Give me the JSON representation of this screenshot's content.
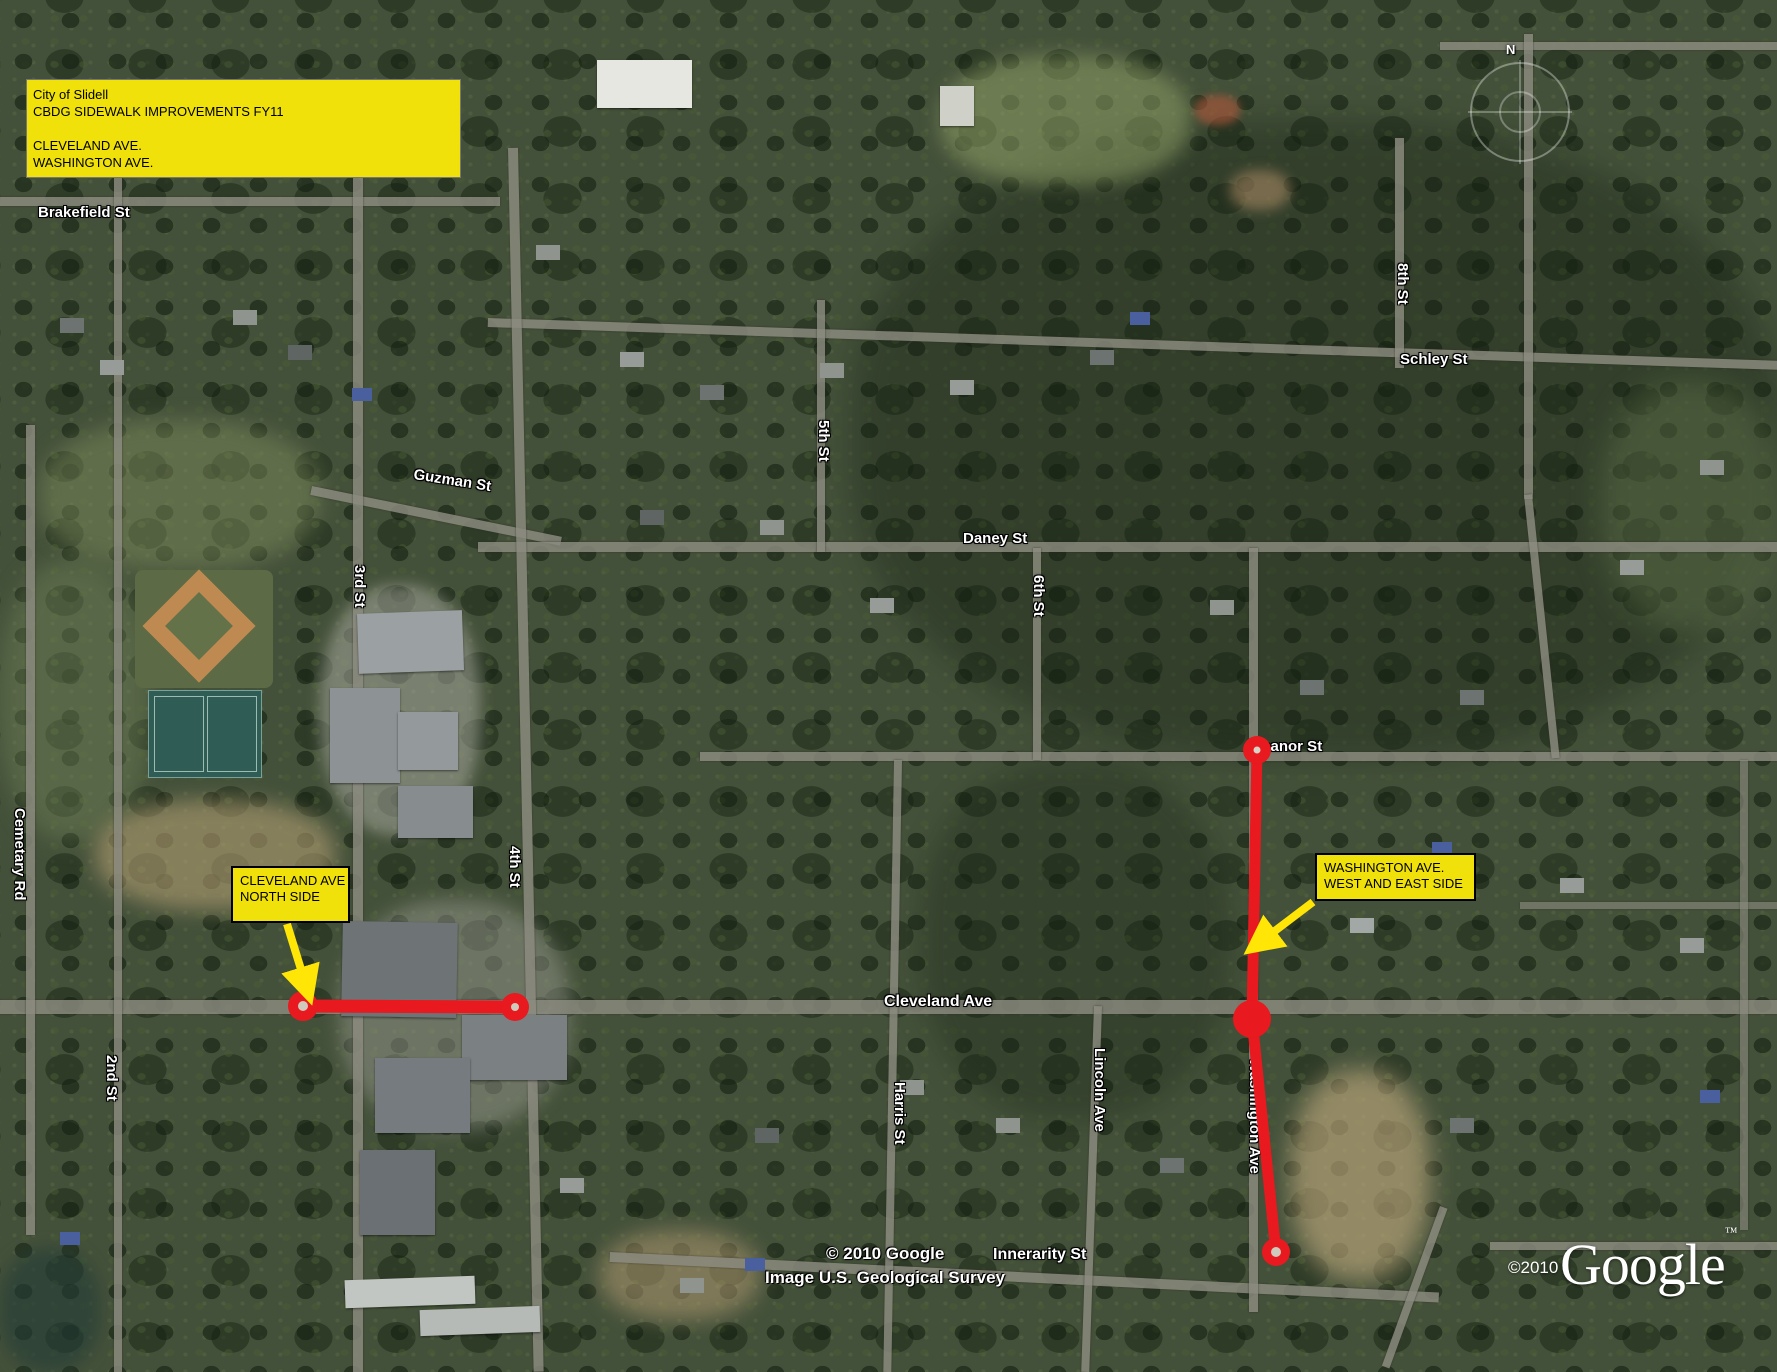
{
  "title_box": {
    "line1": "City of Slidell",
    "line2": "CBDG SIDEWALK IMPROVEMENTS FY11",
    "line3": "CLEVELAND AVE.",
    "line4": "WASHINGTON AVE."
  },
  "callouts": [
    {
      "line1": "CLEVELAND AVE",
      "line2": "NORTH SIDE"
    },
    {
      "line1": "WASHINGTON AVE.",
      "line2": "WEST AND EAST SIDE"
    }
  ],
  "street_labels": {
    "brakefield": "Brakefield St",
    "schley": "Schley St",
    "eighth": "8th St",
    "guzman": "Guzman St",
    "daney": "Daney St",
    "fifth": "5th St",
    "sixth": "6th St",
    "third": "3rd St",
    "fourth": "4th St",
    "cemetary": "Cemetary Rd",
    "second": "2nd St",
    "cleveland": "Cleveland Ave",
    "eleanor": "Eleanor St",
    "harris": "Harris St",
    "lincoln": "Lincoln Ave",
    "innerarity": "Innerarity St",
    "washington": "Washington Ave"
  },
  "compass": {
    "north_label": "N"
  },
  "watermarks": {
    "map_copyright": "© 2010 Google",
    "imagery_credit": "Image U.S. Geological Survey",
    "logo_text": "Google",
    "logo_tm": "™",
    "logo_year": "©2010"
  },
  "colors": {
    "annotation_yellow": "#f0e10a",
    "annotation_red": "#e8191f",
    "street_label_white": "#ffffff",
    "road_gray": "#8c8c80"
  }
}
